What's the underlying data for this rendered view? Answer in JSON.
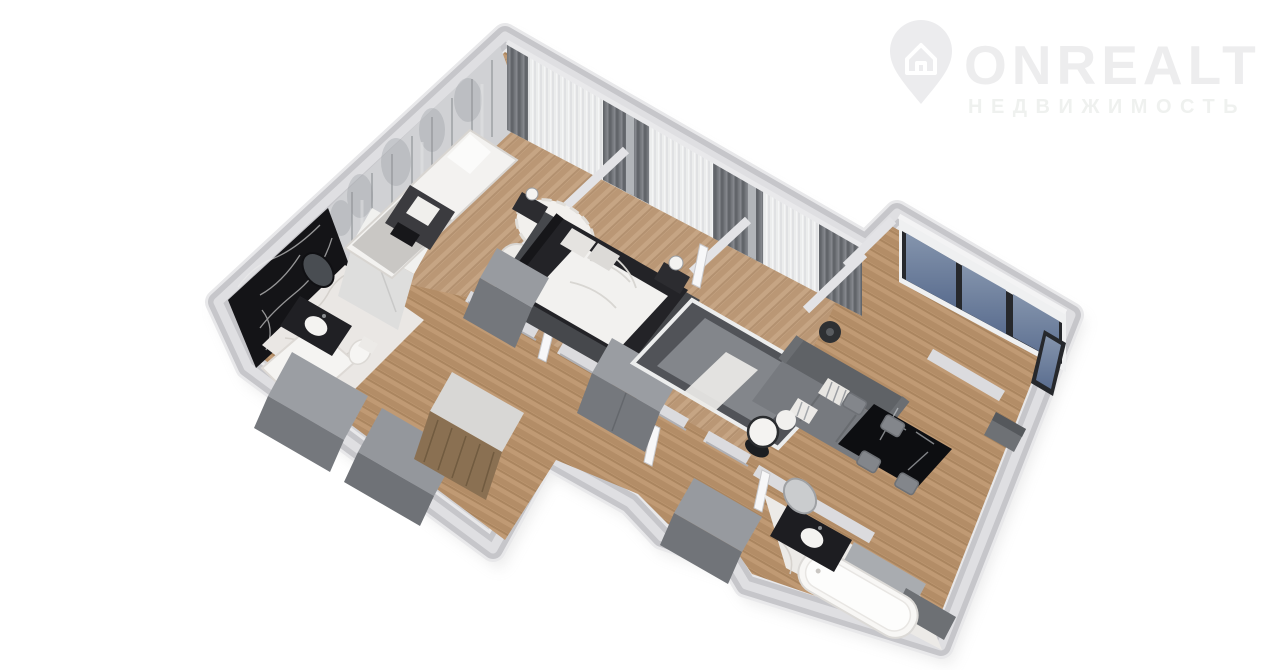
{
  "watermark": {
    "brand": "ONREALT",
    "subtitle": "НЕДВИЖИМОСТЬ",
    "icon": "location-pin-house-icon",
    "brand_color": "#ededee",
    "subtitle_color": "#eff1ef"
  },
  "scene": {
    "type": "3d-floor-plan-render",
    "view": "isometric-top-down",
    "background": "#ffffff",
    "rooms": [
      {
        "name": "children-bedroom",
        "features": [
          "single-bed",
          "forest-wall-mural",
          "dark-desk",
          "white-rug",
          "pouf",
          "curtains"
        ]
      },
      {
        "name": "master-bedroom",
        "features": [
          "double-bed-dark-frame",
          "white-duvet",
          "bedside-tables",
          "lamps",
          "dark-rug",
          "gray-dresser",
          "curtains"
        ]
      },
      {
        "name": "second-bedroom",
        "features": [
          "gray-bed",
          "dark-rug-white-border",
          "floor-lamps",
          "curtains"
        ]
      },
      {
        "name": "living-area",
        "features": [
          "gray-sofa",
          "striped-pillows",
          "round-side-table",
          "floor-lamp"
        ]
      },
      {
        "name": "kitchen-dining",
        "features": [
          "panoramic-windows",
          "black-marble-dining-table",
          "four-gray-chairs",
          "dark-kitchen-unit"
        ]
      },
      {
        "name": "bathroom-black-marble",
        "features": [
          "black-marble-wall",
          "white-marble-floor",
          "dark-vanity",
          "oval-mirror",
          "shower-tray",
          "toilet"
        ]
      },
      {
        "name": "bathroom-white-marble",
        "features": [
          "white-marble-floor",
          "bathtub",
          "dark-vanity",
          "oval-mirror",
          "gray-cabinets"
        ]
      },
      {
        "name": "hallway-entry",
        "features": [
          "gray-wardrobes",
          "wooden-closet",
          "open-doors",
          "wood-floor"
        ]
      }
    ],
    "palette": {
      "wall_side": "#c6c6ca",
      "wall_top": "#dfdfe2",
      "wall_rim": "#e8e8ea",
      "wood_floor_hall": "#c09a74",
      "wood_floor_rooms": "#c6a584",
      "marble_white": "#eceae7",
      "marble_black": "#141417",
      "curtain_dark": "#74777c",
      "curtain_sheer": "#eceded",
      "window_glass_top": "#8595ad",
      "window_glass_bottom": "#5a6d8f",
      "furniture_gray": "#83868b",
      "bed_frame_dark": "#232327",
      "duvet_white": "#f2f1ef"
    }
  }
}
